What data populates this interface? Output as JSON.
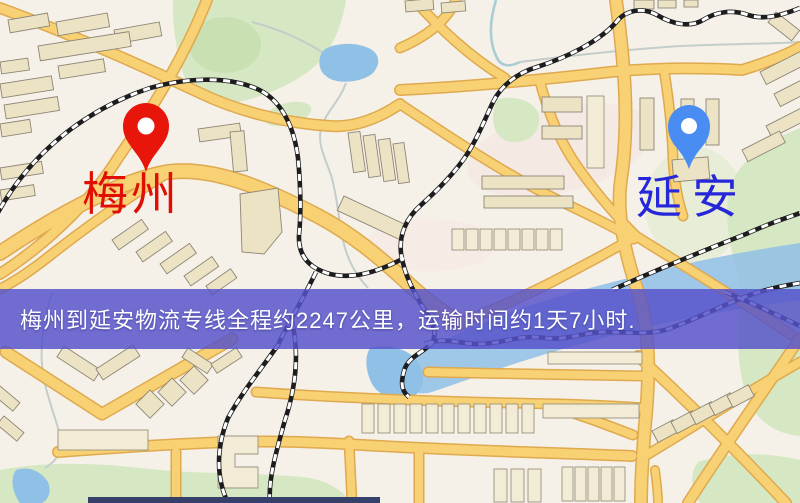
{
  "banner": {
    "text": "梅州到延安物流专线全程约2247公里，运输时间约1天7小时.",
    "background_color": "#5652ca",
    "text_color": "#ffffff"
  },
  "markers": {
    "origin": {
      "label": "梅州",
      "pin_color": "#e8150b",
      "label_color": "#e10e04"
    },
    "destination": {
      "label": "延安",
      "pin_color": "#4a8df2",
      "label_color": "#2527d8"
    }
  },
  "map": {
    "theme_colors": {
      "background": "#f6f1e8",
      "road_fill": "#f7d173",
      "road_casing": "#dfa94f",
      "building": "#ece2c4",
      "park_green": "#d6e8c3",
      "water_blue": "#8fc0e6",
      "railway": "#1d1d1f"
    }
  }
}
